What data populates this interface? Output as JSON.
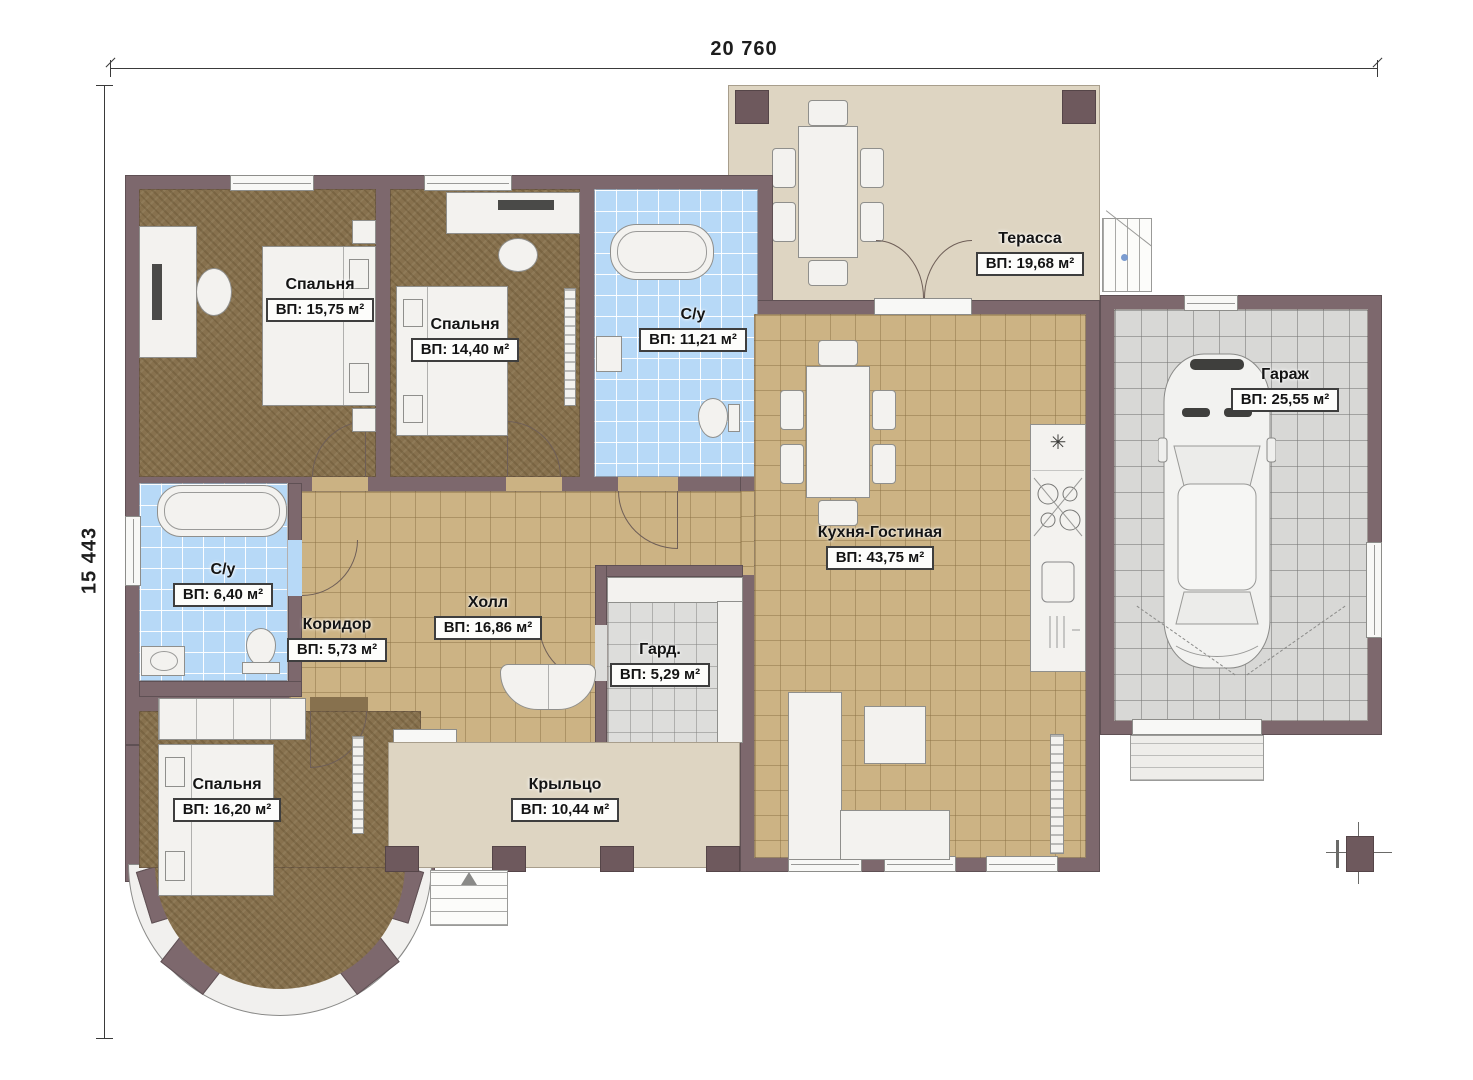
{
  "dimensions": {
    "width": "20 760",
    "height": "15 443"
  },
  "rooms": [
    {
      "name": "Спальня",
      "area": "ВП: 15,75 м²"
    },
    {
      "name": "Спальня",
      "area": "ВП: 14,40 м²"
    },
    {
      "name": "С/у",
      "area": "ВП: 11,21 м²"
    },
    {
      "name": "Терасса",
      "area": "ВП: 19,68 м²"
    },
    {
      "name": "Гараж",
      "area": "ВП: 25,55 м²"
    },
    {
      "name": "Кухня-Гостиная",
      "area": "ВП: 43,75 м²"
    },
    {
      "name": "С/у",
      "area": "ВП: 6,40 м²"
    },
    {
      "name": "Коридор",
      "area": "ВП: 5,73 м²"
    },
    {
      "name": "Холл",
      "area": "ВП: 16,86 м²"
    },
    {
      "name": "Гард.",
      "area": "ВП: 5,29 м²"
    },
    {
      "name": "Спальня",
      "area": "ВП: 16,20 м²"
    },
    {
      "name": "Крыльцо",
      "area": "ВП: 10,44 м²"
    }
  ],
  "symbols": {
    "kitchen_vent": "✳"
  },
  "colors": {
    "wall": "#7d686d",
    "wood_floor": "#87714e",
    "tan_tile": "#ccb384",
    "blue_tile": "#b7d9f7",
    "gray_tile": "#d8d8d6",
    "outdoor_floor": "#ded5c2",
    "furniture": "#f3f2ef"
  }
}
